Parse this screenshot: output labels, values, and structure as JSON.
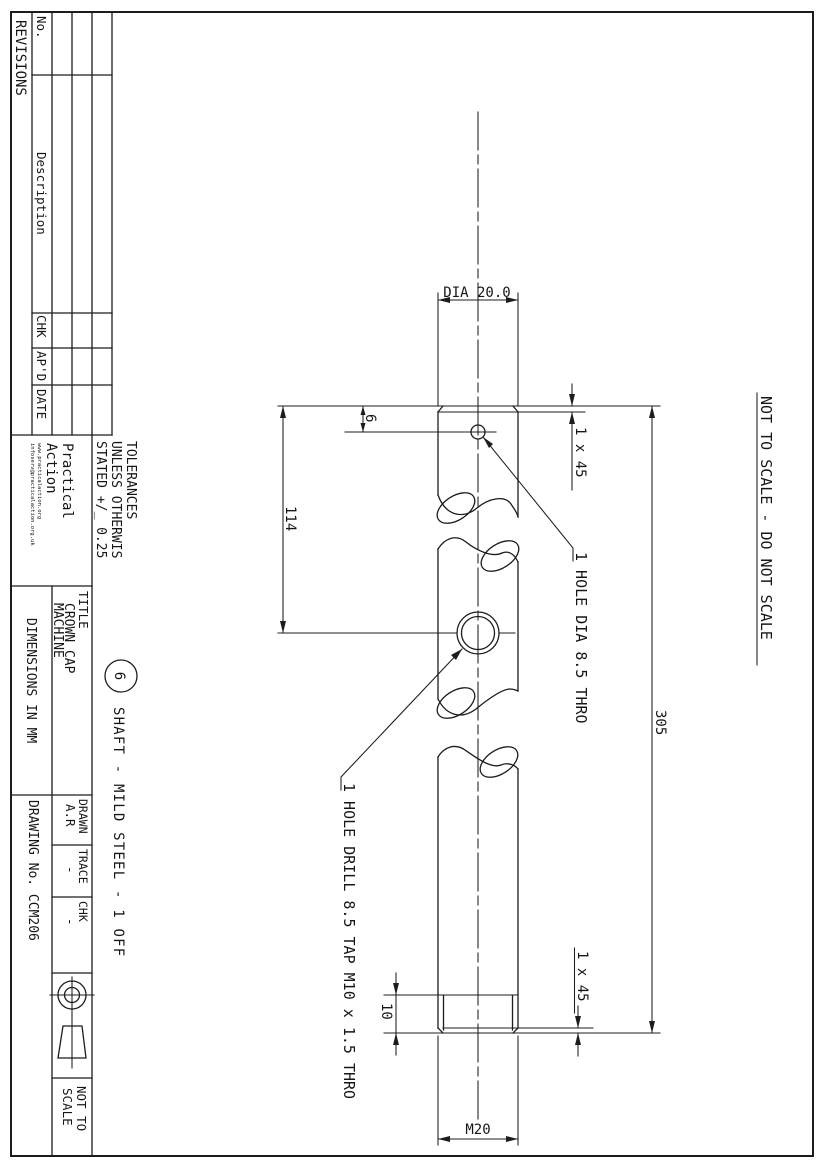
{
  "revisions": {
    "title": "REVISIONS",
    "col_no": "No.",
    "col_description": "Description",
    "col_chk": "CHK",
    "col_apd": "AP'D",
    "col_date": "DATE"
  },
  "org": {
    "line1": "Practical",
    "line2": "Action",
    "url": "www.practicalaction.org",
    "email": "infoserv@practicalaction.org.uk"
  },
  "tolerances": {
    "line1": "TOLERANCES",
    "line2": "UNLESS OTHERWIS",
    "line3": "STATED +/_ 0.25"
  },
  "title_block": {
    "title_label": "TITLE",
    "title_value_line1": "CROWN CAP",
    "title_value_line2": "MACHINE",
    "dimensions_note": "DIMENSIONS IN MM",
    "drawn_label": "DRAWN",
    "drawn_value": "A.R",
    "trace_label": "TRACE",
    "trace_value": "-",
    "chk_label": "CHK",
    "chk_value": "-",
    "drawing_no": "DRAWING No. CCM206",
    "scale_line1": "NOT TO",
    "scale_line2": "SCALE"
  },
  "part_note": {
    "balloon": "6",
    "label": "SHAFT  -  MILD STEEL - 1 OFF"
  },
  "warnings": {
    "not_to_scale": "NOT TO SCALE - DO NOT SCALE"
  },
  "dimensions": {
    "diameter": "DIA 20.0",
    "overall_length": "305",
    "hole_distance": "114",
    "hole_offset": "6",
    "thread_length": "10",
    "thread_size": "M20",
    "chamfer_top": "1 x 45",
    "chamfer_bottom": "1 x 45"
  },
  "notes": {
    "top_hole": "1 HOLE DIA 8.5 THRO",
    "mid_hole": "1 HOLE DRILL 8.5 TAP M10 x 1.5 THRO"
  }
}
